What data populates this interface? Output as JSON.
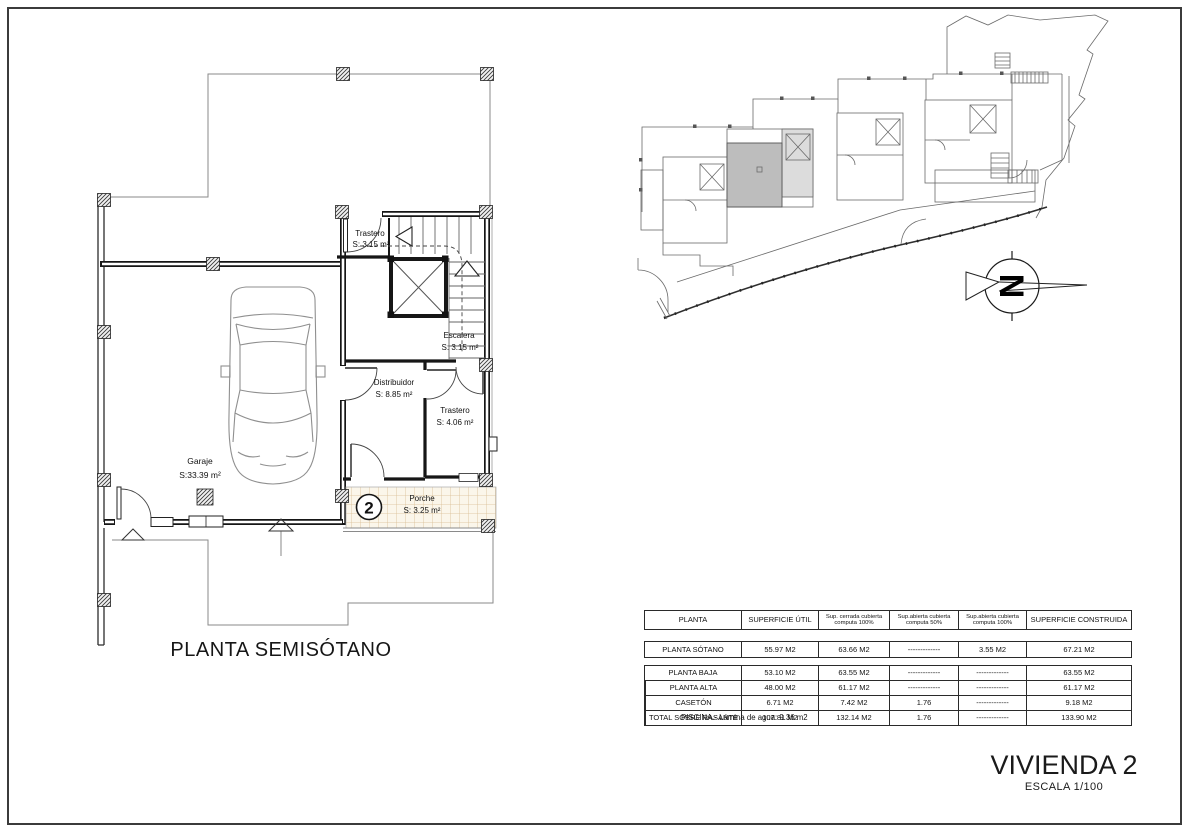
{
  "sheet": {
    "background": "#ffffff",
    "border_color": "#3b3b3b",
    "colors": {
      "highlighted_unit_fill": "#bdbdbd",
      "unit_stair_fill": "#dcdcdc",
      "porche_tile_fill": "#fbf6ea",
      "porche_tile_line": "#d8bd93",
      "wall_color": "#161616"
    }
  },
  "floor_plan": {
    "title": "PLANTA SEMISÓTANO",
    "unit_badge": "2",
    "rooms": [
      {
        "name": "Trastero",
        "area": "S: 3.15 m²"
      },
      {
        "name": "Escalera",
        "area": "S: 3.15 m²"
      },
      {
        "name": "Distribuidor",
        "area": "S: 8.85 m²"
      },
      {
        "name": "Trastero",
        "area": "S: 4.06 m²"
      },
      {
        "name": "Garaje",
        "area": "S:33.39 m²"
      },
      {
        "name": "Porche",
        "area": "S: 3.25 m²"
      }
    ]
  },
  "site_plan": {
    "north_letter": "N"
  },
  "areas_table": {
    "headers": [
      {
        "l1": "PLANTA",
        "l2": ""
      },
      {
        "l1": "SUPERFICIE ÚTIL",
        "l2": ""
      },
      {
        "l1": "Sup. cerrada cubierta",
        "l2": "computa 100%"
      },
      {
        "l1": "Sup.abierta cubierta",
        "l2": "computa 50%"
      },
      {
        "l1": "Sup.abierta cubierta",
        "l2": "computa 100%"
      },
      {
        "l1": "SUPERFICIE CONSTRUIDA",
        "l2": ""
      }
    ],
    "sotano_row": [
      "PLANTA SÓTANO",
      "55.97 M2",
      "63.66 M2",
      "-------------",
      "3.55 M2",
      "67.21 M2"
    ],
    "body_rows": [
      [
        "PLANTA BAJA",
        "53.10 M2",
        "63.55 M2",
        "-------------",
        "-------------",
        "63.55 M2"
      ],
      [
        "PLANTA ALTA",
        "48.00 M2",
        "61.17 M2",
        "-------------",
        "-------------",
        "61.17 M2"
      ],
      [
        "CASETÓN",
        "6.71 M2",
        "7.42 M2",
        "1.76",
        "-------------",
        "9.18 M2"
      ],
      [
        "TOTAL SOBRE RASANTE",
        "107.81 M2",
        "132.14 M2",
        "1.76",
        "-------------",
        "133.90 M2"
      ]
    ],
    "note": "PISCINA.- Lámina de agua: 9.36 m2"
  },
  "title_block": {
    "project": "VIVIENDA 2",
    "scale": "ESCALA 1/100"
  }
}
